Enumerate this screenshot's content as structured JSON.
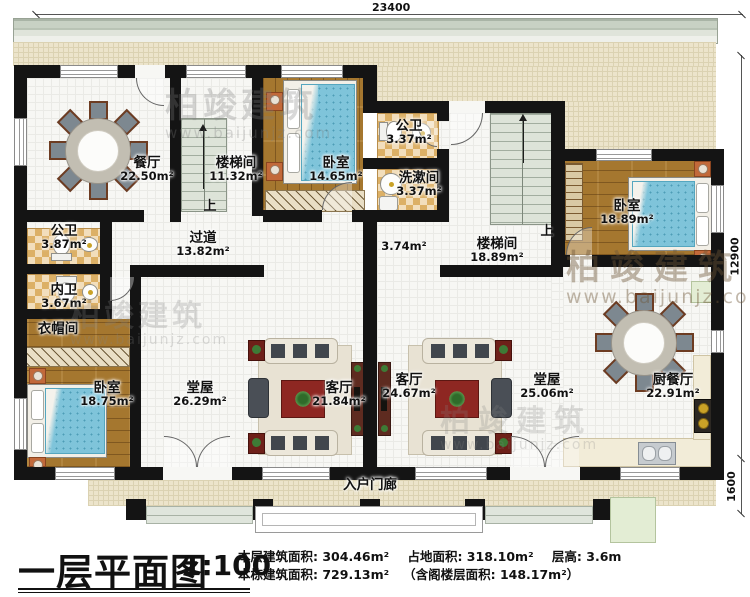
{
  "title": {
    "name": "一层平面图",
    "scale": "1:100"
  },
  "stats": {
    "floor_area": "本层建筑面积: 304.46m²",
    "land_area": "占地面积: 318.10m²",
    "storey_height": "层高: 3.6m",
    "total_area": "本栋建筑面积: 729.13m²",
    "attic_note": "（含阁楼层面积: 148.17m²）"
  },
  "dimensions": {
    "top_width": "23400",
    "right_height": "12900",
    "porch_depth": "1600"
  },
  "stair_up_label": "上",
  "watermark": {
    "brand": "柏竣建筑",
    "url": "www.baijunjz.com"
  },
  "rooms": [
    {
      "id": "dining",
      "name": "餐厅",
      "area": "22.50m²"
    },
    {
      "id": "stair-left",
      "name": "楼梯间",
      "area": "11.32m²"
    },
    {
      "id": "bedroom-top",
      "name": "卧室",
      "area": "14.65m²"
    },
    {
      "id": "bath-top",
      "name": "公卫",
      "area": "3.37m²"
    },
    {
      "id": "washroom",
      "name": "洗漱间",
      "area": "3.37m²"
    },
    {
      "id": "bath-left",
      "name": "公卫",
      "area": "3.87m²"
    },
    {
      "id": "bath-inner",
      "name": "内卫",
      "area": "3.67m²"
    },
    {
      "id": "cloakroom",
      "name": "衣帽间",
      "area": ""
    },
    {
      "id": "corridor",
      "name": "过道",
      "area": "13.82m²"
    },
    {
      "id": "corridor-small",
      "name": "",
      "area": "3.74m²"
    },
    {
      "id": "stair-right",
      "name": "楼梯间",
      "area": "18.89m²"
    },
    {
      "id": "bedroom-right",
      "name": "卧室",
      "area": "18.89m²"
    },
    {
      "id": "bedroom-left",
      "name": "卧室",
      "area": "18.75m²"
    },
    {
      "id": "hall-left",
      "name": "堂屋",
      "area": "26.29m²"
    },
    {
      "id": "living-left",
      "name": "客厅",
      "area": "21.84m²"
    },
    {
      "id": "living-right",
      "name": "客厅",
      "area": "24.67m²"
    },
    {
      "id": "hall-right",
      "name": "堂屋",
      "area": "25.06m²"
    },
    {
      "id": "kitchen-dining",
      "name": "厨餐厅",
      "area": "22.91m²"
    },
    {
      "id": "entrance-porch",
      "name": "入户门廊",
      "area": ""
    }
  ]
}
